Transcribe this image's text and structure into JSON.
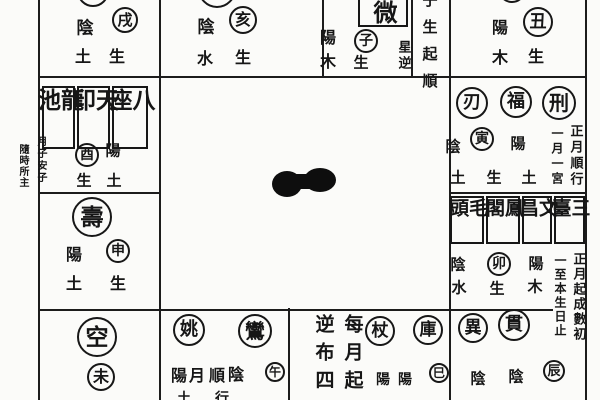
{
  "page": {
    "description": "Scanned page of a traditional Chinese twelve-palace divination (Zi Wei Dou Shu style) star-placement chart; outer palaces around an empty center with an ink blot",
    "background_color": "#fbfbf9",
    "ink_color": "#171717"
  },
  "regions": [
    {
      "name": "palace-top-1",
      "items": [
        {
          "type": "circle",
          "t": "",
          "name": "cut-star-circle",
          "cx": 93,
          "cy": -9,
          "r": 16
        },
        {
          "type": "char",
          "t": "陰",
          "name": "yin-label",
          "x": 85,
          "y": 29,
          "fs": 17
        },
        {
          "type": "circle",
          "t": "戌",
          "name": "branch-xu-circle",
          "cx": 125,
          "cy": 20,
          "r": 13
        },
        {
          "type": "char",
          "t": "土",
          "name": "element-earth-label",
          "x": 83,
          "y": 57,
          "fs": 16
        },
        {
          "type": "char",
          "t": "生",
          "name": "sheng-label",
          "x": 117,
          "y": 57,
          "fs": 16
        }
      ]
    },
    {
      "name": "palace-top-2",
      "items": [
        {
          "type": "circle",
          "t": "",
          "name": "cut-star-circle",
          "cx": 217,
          "cy": -11,
          "r": 19
        },
        {
          "type": "char",
          "t": "陰",
          "name": "yin-label",
          "x": 206,
          "y": 28,
          "fs": 17
        },
        {
          "type": "circle",
          "t": "亥",
          "name": "branch-hai-circle",
          "cx": 243,
          "cy": 20,
          "r": 14
        },
        {
          "type": "char",
          "t": "水",
          "name": "element-water-label",
          "x": 205,
          "y": 59,
          "fs": 16
        },
        {
          "type": "char",
          "t": "生",
          "name": "sheng-label",
          "x": 243,
          "y": 58,
          "fs": 16
        }
      ]
    },
    {
      "name": "palace-top-3",
      "items": [
        {
          "type": "box",
          "t": "微",
          "name": "ziwei-star-box",
          "x": 358,
          "y": -13,
          "w": 50,
          "h": 40,
          "fs": 24,
          "sp": 0,
          "pt": 10
        },
        {
          "type": "char",
          "t": "陽",
          "name": "yang-label",
          "x": 328,
          "y": 38,
          "fs": 16
        },
        {
          "type": "circle",
          "t": "子",
          "name": "branch-zi-circle",
          "cx": 366,
          "cy": 41,
          "r": 12
        },
        {
          "type": "char",
          "t": "木",
          "name": "element-wood-label",
          "x": 328,
          "y": 62,
          "fs": 16
        },
        {
          "type": "char",
          "t": "生",
          "name": "sheng-label",
          "x": 361,
          "y": 63,
          "fs": 15
        },
        {
          "type": "vnote",
          "t": "星逆",
          "name": "note-star-reverse",
          "cx": 403,
          "top": 40,
          "fs": 13,
          "sp": 3
        }
      ]
    },
    {
      "name": "rule-strip-top",
      "items": [
        {
          "type": "vnote",
          "t": "子生起順",
          "name": "note-zi-sheng-qi-shun",
          "cx": 429,
          "top": -8,
          "fs": 15,
          "sp": 12
        }
      ]
    },
    {
      "name": "palace-top-4",
      "items": [
        {
          "type": "circle",
          "t": "",
          "name": "cut-star-circle",
          "cx": 512,
          "cy": -11,
          "r": 14
        },
        {
          "type": "char",
          "t": "陽",
          "name": "yang-label",
          "x": 500,
          "y": 28,
          "fs": 16
        },
        {
          "type": "circle",
          "t": "丑",
          "name": "branch-chou-circle",
          "cx": 538,
          "cy": 22,
          "r": 15
        },
        {
          "type": "char",
          "t": "木",
          "name": "element-wood-label",
          "x": 500,
          "y": 58,
          "fs": 16
        },
        {
          "type": "char",
          "t": "生",
          "name": "sheng-label",
          "x": 536,
          "y": 57,
          "fs": 16
        }
      ]
    },
    {
      "name": "palace-left-2",
      "items": [
        {
          "type": "box",
          "t": "龍池",
          "name": "longchi-star-box",
          "x": 42,
          "y": 86,
          "w": 33,
          "h": 63,
          "fs": 23,
          "sp": 8
        },
        {
          "type": "box",
          "t": "天印",
          "name": "tianyin-star-box",
          "x": 77,
          "y": 86,
          "w": 33,
          "h": 63,
          "fs": 23,
          "sp": 8
        },
        {
          "type": "box",
          "t": "八座",
          "name": "bazuo-star-box",
          "x": 112,
          "y": 86,
          "w": 36,
          "h": 63,
          "fs": 23,
          "sp": 8
        },
        {
          "type": "vnote",
          "t": "月子安子",
          "name": "note-small-margin-right",
          "cx": 40,
          "top": 136,
          "fs": 10,
          "sp": 2
        },
        {
          "type": "vnote",
          "t": "隨時所主",
          "name": "note-small-margin-left",
          "cx": 22,
          "top": 144,
          "fs": 10,
          "sp": 1
        },
        {
          "type": "circle",
          "t": "酉",
          "name": "branch-you-circle",
          "cx": 87,
          "cy": 155,
          "r": 12
        },
        {
          "type": "char",
          "t": "陽",
          "name": "yang-label",
          "x": 113,
          "y": 151,
          "fs": 15
        },
        {
          "type": "char",
          "t": "生",
          "name": "sheng-label",
          "x": 84,
          "y": 181,
          "fs": 15
        },
        {
          "type": "char",
          "t": "土",
          "name": "element-earth-label",
          "x": 114,
          "y": 181,
          "fs": 15
        }
      ]
    },
    {
      "name": "palace-right-2",
      "items": [
        {
          "type": "circle",
          "t": "刃",
          "name": "ren-star-circle",
          "cx": 472,
          "cy": 103,
          "r": 16
        },
        {
          "type": "circle",
          "t": "福",
          "name": "fu-star-circle",
          "cx": 516,
          "cy": 102,
          "r": 16
        },
        {
          "type": "circle",
          "t": "刑",
          "name": "xing-star-circle",
          "cx": 559,
          "cy": 103,
          "r": 17
        },
        {
          "type": "char",
          "t": "陰",
          "name": "yin-label",
          "x": 453,
          "y": 147,
          "fs": 15
        },
        {
          "type": "circle",
          "t": "寅",
          "name": "branch-yin-circle",
          "cx": 482,
          "cy": 139,
          "r": 12
        },
        {
          "type": "char",
          "t": "陽",
          "name": "yang-label",
          "x": 518,
          "y": 144,
          "fs": 15
        },
        {
          "type": "vnote",
          "t": "正月順行",
          "name": "note-first-month-forward",
          "cx": 575,
          "top": 124,
          "fs": 13,
          "sp": 3
        },
        {
          "type": "vnote",
          "t": "一月一宮",
          "name": "note-one-month-one-palace",
          "cx": 557,
          "top": 127,
          "fs": 12,
          "sp": 3
        },
        {
          "type": "char",
          "t": "土",
          "name": "element-earth-label",
          "x": 458,
          "y": 178,
          "fs": 15
        },
        {
          "type": "char",
          "t": "生",
          "name": "sheng-label",
          "x": 494,
          "y": 178,
          "fs": 15
        },
        {
          "type": "char",
          "t": "土",
          "name": "element-earth-label",
          "x": 529,
          "y": 178,
          "fs": 15
        }
      ]
    },
    {
      "name": "palace-left-3",
      "items": [
        {
          "type": "circle",
          "t": "壽",
          "name": "shou-star-circle",
          "cx": 92,
          "cy": 217,
          "r": 20
        },
        {
          "type": "char",
          "t": "陽",
          "name": "yang-label",
          "x": 74,
          "y": 255,
          "fs": 16
        },
        {
          "type": "circle",
          "t": "申",
          "name": "branch-shen-circle",
          "cx": 118,
          "cy": 251,
          "r": 12
        },
        {
          "type": "char",
          "t": "土",
          "name": "element-earth-label",
          "x": 74,
          "y": 284,
          "fs": 16
        },
        {
          "type": "char",
          "t": "生",
          "name": "sheng-label",
          "x": 118,
          "y": 284,
          "fs": 16
        }
      ]
    },
    {
      "name": "palace-right-3",
      "items": [
        {
          "type": "box",
          "t": "毛頭",
          "name": "maotou-star-box",
          "x": 450,
          "y": 196,
          "w": 34,
          "h": 48,
          "fs": 19,
          "sp": 5
        },
        {
          "type": "box",
          "t": "鳳閣",
          "name": "fengge-star-box",
          "x": 486,
          "y": 196,
          "w": 34,
          "h": 48,
          "fs": 19,
          "sp": 5
        },
        {
          "type": "box",
          "t": "文昌",
          "name": "wenchang-star-box",
          "x": 522,
          "y": 196,
          "w": 30,
          "h": 48,
          "fs": 19,
          "sp": 5
        },
        {
          "type": "box",
          "t": "三臺",
          "name": "santai-star-box",
          "x": 554,
          "y": 196,
          "w": 31,
          "h": 48,
          "fs": 19,
          "sp": 5
        },
        {
          "type": "char",
          "t": "陰",
          "name": "yin-label",
          "x": 458,
          "y": 265,
          "fs": 15
        },
        {
          "type": "circle",
          "t": "卯",
          "name": "branch-mao-circle",
          "cx": 499,
          "cy": 264,
          "r": 12
        },
        {
          "type": "char",
          "t": "陽",
          "name": "yang-label",
          "x": 536,
          "y": 264,
          "fs": 15
        },
        {
          "type": "vnote",
          "t": "正月起成數初",
          "name": "note-first-month-count",
          "cx": 578,
          "top": 252,
          "fs": 13,
          "sp": 2
        },
        {
          "type": "vnote",
          "t": "一至本生日止",
          "name": "note-until-birthday",
          "cx": 560,
          "top": 254,
          "fs": 12,
          "sp": 2
        },
        {
          "type": "char",
          "t": "水",
          "name": "element-water-label",
          "x": 459,
          "y": 288,
          "fs": 15
        },
        {
          "type": "char",
          "t": "生",
          "name": "sheng-label",
          "x": 497,
          "y": 289,
          "fs": 15
        },
        {
          "type": "char",
          "t": "木",
          "name": "element-wood-label",
          "x": 535,
          "y": 287,
          "fs": 15
        }
      ]
    },
    {
      "name": "palace-bottom-1",
      "items": [
        {
          "type": "circle",
          "t": "空",
          "name": "kong-star-circle",
          "cx": 97,
          "cy": 337,
          "r": 20
        },
        {
          "type": "circle",
          "t": "未",
          "name": "branch-wei-circle",
          "cx": 101,
          "cy": 377,
          "r": 14
        }
      ]
    },
    {
      "name": "palace-bottom-2",
      "items": [
        {
          "type": "circle",
          "t": "姚",
          "name": "yao-star-circle",
          "cx": 189,
          "cy": 330,
          "r": 16
        },
        {
          "type": "circle",
          "t": "鸞",
          "name": "luan-star-circle",
          "cx": 255,
          "cy": 331,
          "r": 17
        },
        {
          "type": "char",
          "t": "陽",
          "name": "yang-label",
          "x": 179,
          "y": 376,
          "fs": 16
        },
        {
          "type": "char",
          "t": "月",
          "name": "month-label",
          "x": 197,
          "y": 376,
          "fs": 16
        },
        {
          "type": "char",
          "t": "順",
          "name": "shun-label",
          "x": 217,
          "y": 376,
          "fs": 16
        },
        {
          "type": "char",
          "t": "陰",
          "name": "yin-label",
          "x": 236,
          "y": 375,
          "fs": 16
        },
        {
          "type": "circle",
          "t": "午",
          "name": "branch-wu-circle",
          "cx": 275,
          "cy": 372,
          "r": 10
        },
        {
          "type": "char",
          "t": "土",
          "name": "partial-cut-char",
          "x": 184,
          "y": 399,
          "fs": 14
        },
        {
          "type": "char",
          "t": "行",
          "name": "partial-cut-char",
          "x": 222,
          "y": 399,
          "fs": 14
        }
      ]
    },
    {
      "name": "palace-bottom-3",
      "items": [
        {
          "type": "vnote",
          "t": "每月起",
          "name": "note-every-month-start",
          "cx": 352,
          "top": 314,
          "fs": 19,
          "sp": 9
        },
        {
          "type": "vnote",
          "t": "逆布四",
          "name": "note-reverse-spread-four",
          "cx": 323,
          "top": 314,
          "fs": 19,
          "sp": 9
        },
        {
          "type": "circle",
          "t": "杖",
          "name": "zhang-star-circle",
          "cx": 380,
          "cy": 331,
          "r": 15
        },
        {
          "type": "circle",
          "t": "庫",
          "name": "ku-star-circle",
          "cx": 428,
          "cy": 330,
          "r": 15
        },
        {
          "type": "char",
          "t": "陽",
          "name": "yang-label",
          "x": 383,
          "y": 380,
          "fs": 14
        },
        {
          "type": "char",
          "t": "陽",
          "name": "yang-label",
          "x": 405,
          "y": 380,
          "fs": 14
        },
        {
          "type": "circle",
          "t": "巳",
          "name": "branch-si-circle",
          "cx": 439,
          "cy": 373,
          "r": 10
        }
      ]
    },
    {
      "name": "palace-bottom-4",
      "items": [
        {
          "type": "circle",
          "t": "異",
          "name": "yi-star-circle",
          "cx": 473,
          "cy": 328,
          "r": 15
        },
        {
          "type": "circle",
          "t": "貫",
          "name": "guan-star-circle",
          "cx": 514,
          "cy": 325,
          "r": 16
        },
        {
          "type": "char",
          "t": "陰",
          "name": "yin-label",
          "x": 478,
          "y": 379,
          "fs": 15
        },
        {
          "type": "char",
          "t": "陰",
          "name": "yin-label",
          "x": 516,
          "y": 377,
          "fs": 15
        },
        {
          "type": "circle",
          "t": "辰",
          "name": "branch-chen-circle",
          "cx": 554,
          "cy": 371,
          "r": 11
        }
      ]
    }
  ]
}
